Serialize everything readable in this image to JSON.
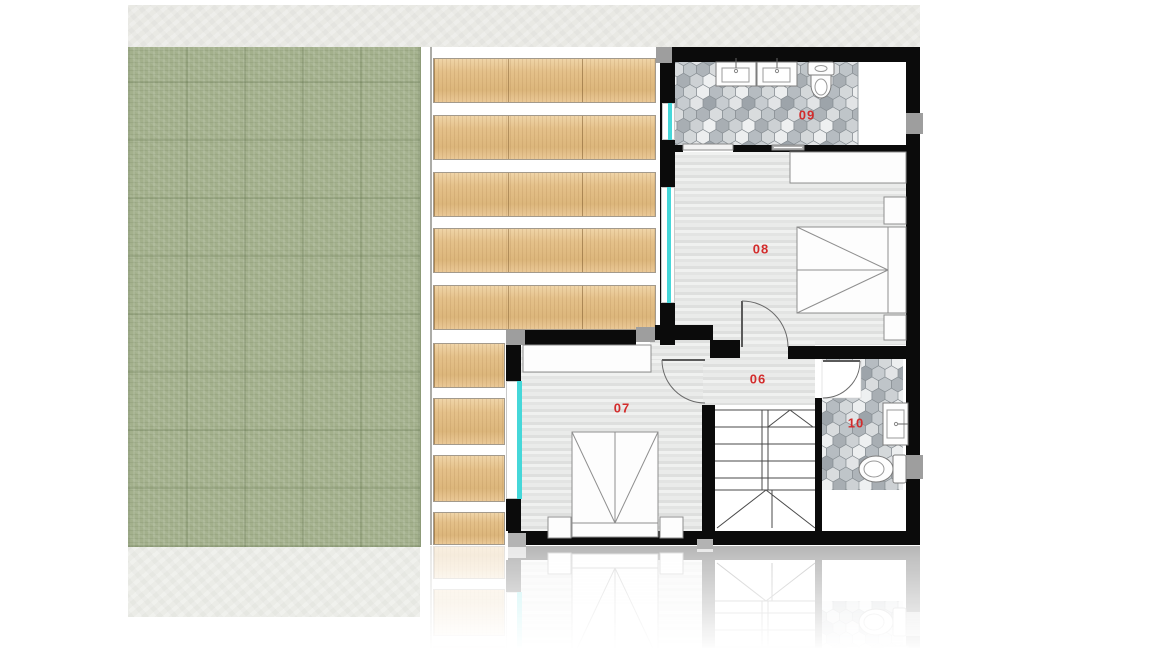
{
  "rooms": [
    {
      "label": "06"
    },
    {
      "label": "07"
    },
    {
      "label": "08"
    },
    {
      "label": "09"
    },
    {
      "label": "10"
    }
  ],
  "colors": {
    "room_label": "#d32b2b",
    "wall": "#0b0b0b",
    "window_glass": "#45d7d9",
    "grass": "#a3b08c",
    "deck_wood": "#e3bf88",
    "plank_floor": "#e6e7e6",
    "tile_grout": "#878e93"
  }
}
